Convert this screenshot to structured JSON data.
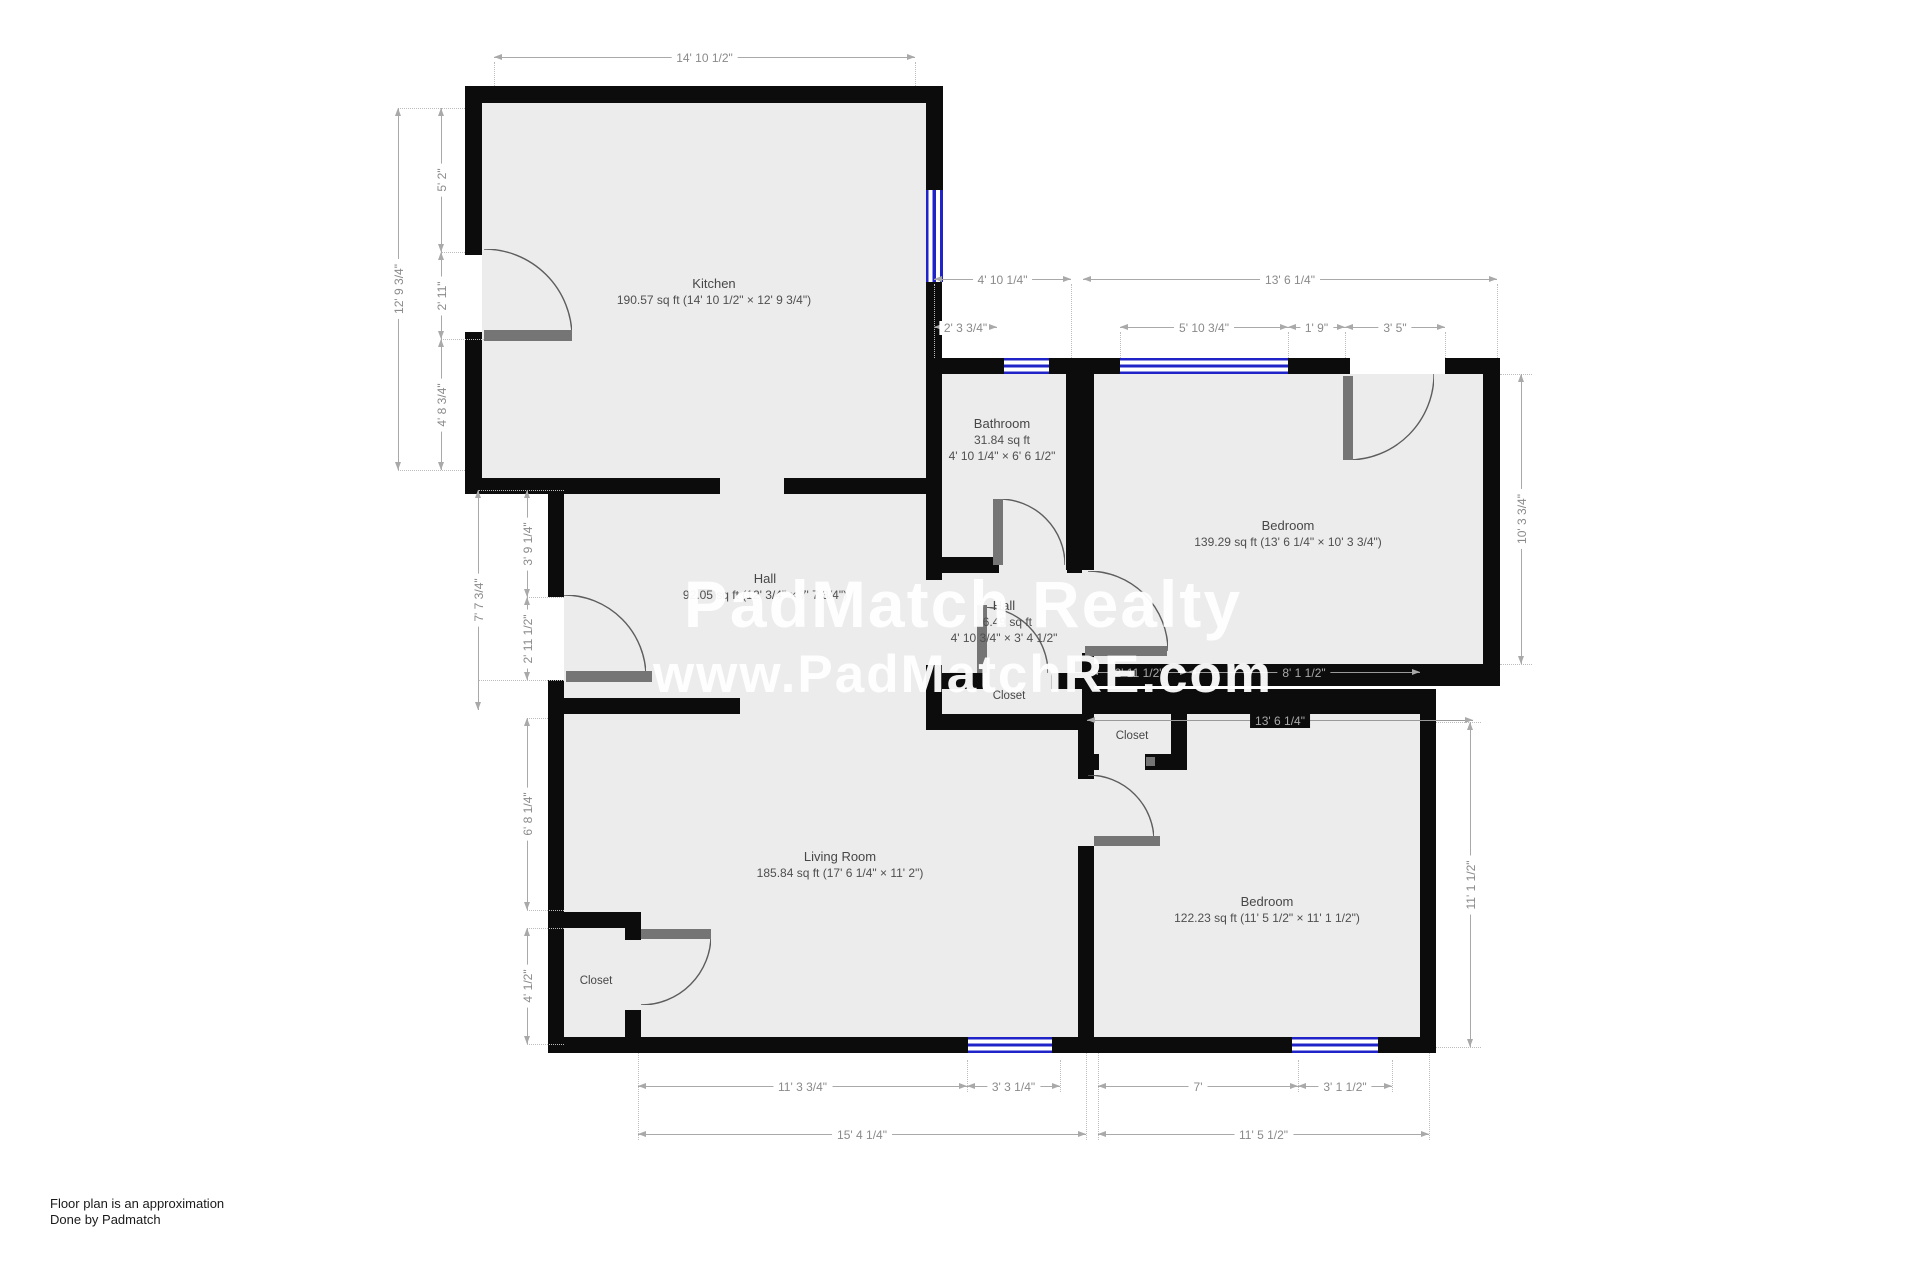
{
  "watermark": {
    "line1": "PadMatch Realty",
    "line2": "www.PadMatchRE.com"
  },
  "footer": {
    "line1": "Floor plan is an approximation",
    "line2": "Done by Padmatch"
  },
  "rooms": {
    "kitchen": {
      "name": "Kitchen",
      "details": "190.57 sq ft (14' 10 1/2\" × 12' 9 3/4\")"
    },
    "bathroom": {
      "name": "Bathroom",
      "area": "31.84 sq ft",
      "size": "4' 10 1/4\" × 6' 6 1/2\""
    },
    "bedroom1": {
      "name": "Bedroom",
      "details": "139.29 sq ft (13' 6 1/4\" × 10' 3 3/4\")"
    },
    "hall": {
      "name": "Hall",
      "details": "92.05 sq ft (12' 3/4\" × 7' 7 3/4\")"
    },
    "hall2": {
      "name": "Hall",
      "area": "16.49 sq ft",
      "size": "4' 10 3/4\" × 3' 4 1/2\""
    },
    "closet_hall": {
      "name": "Closet"
    },
    "closet_bedroom2": {
      "name": "Closet"
    },
    "living": {
      "name": "Living Room",
      "details": "185.84 sq ft (17' 6 1/4\" × 11' 2\")"
    },
    "bedroom2": {
      "name": "Bedroom",
      "details": "122.23 sq ft (11' 5 1/2\" × 11' 1 1/2\")"
    },
    "closet_living": {
      "name": "Closet"
    }
  },
  "dimensions": {
    "kitchen_width": "14' 10 1/2\"",
    "kitchen_height": "12' 9 3/4\"",
    "kitchen_seg_top": "5' 2\"",
    "kitchen_seg_door": "2' 11\"",
    "kitchen_seg_bottom": "4' 8 3/4\"",
    "bath_width": "4' 10 1/4\"",
    "bed1_width": "13' 6 1/4\"",
    "bath_seg": "2' 3 3/4\"",
    "bed1_window": "5' 10 3/4\"",
    "bed1_pier": "1' 9\"",
    "bed1_door": "3' 5\"",
    "bed1_height": "10' 3 3/4\"",
    "hall_seg_top": "3' 9 1/4\"",
    "hall_door": "2' 11 1/2\"",
    "hall_height": "7' 7 3/4\"",
    "bed1_closet": "2' 11 1/2\"",
    "bed1_bottom": "8' 1 1/2\"",
    "bed2_top": "13' 6 1/4\"",
    "bed2_height": "11' 1 1/2\"",
    "living_seg_top": "6' 8 1/4\"",
    "living_closet": "4' 1/2\"",
    "living_bottom_a": "11' 3 3/4\"",
    "living_bottom_b": "3' 3 1/4\"",
    "bed2_bottom_a": "7'",
    "bed2_bottom_b": "3' 1 1/2\"",
    "living_width": "15' 4 1/4\"",
    "bed2_width": "11' 5 1/2\""
  },
  "colors": {
    "wall": "#0c0c0c",
    "floor": "#ececec",
    "window": "#2024c8",
    "dimension": "#8a8a8a",
    "watermark": "#ffffff"
  }
}
